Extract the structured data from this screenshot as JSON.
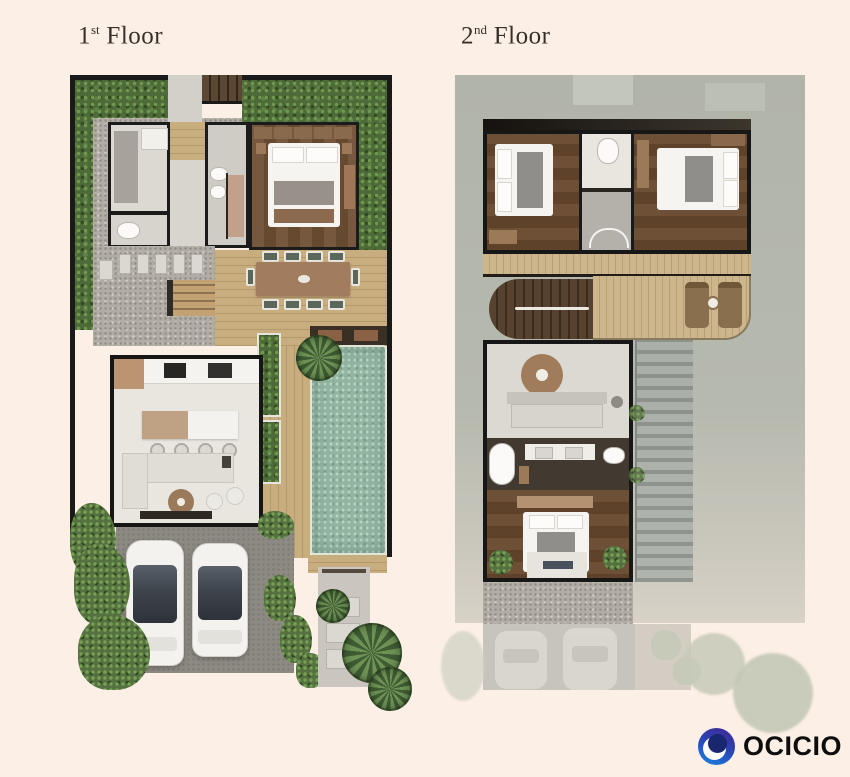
{
  "page": {
    "background_color": "#fcefe6"
  },
  "header": {
    "floor1": {
      "number": "1",
      "ordinal": "st",
      "word": "Floor"
    },
    "floor2": {
      "number": "2",
      "ordinal": "nd",
      "word": "Floor"
    }
  },
  "brand": {
    "name": "OCICIO",
    "text_color": "#0d0d0d",
    "mark_colors": {
      "indigo": "#3a2f9d",
      "blue": "#1b74d8",
      "core_navy": "#18276f",
      "swoosh": "#ffffff"
    }
  },
  "palette": {
    "title_text": "#37302a",
    "hedge_green": "#4d6a39",
    "gravel": "#b1ada5",
    "deck_wood": "#c8ad7f",
    "dark_wood_floor": "#6d5036",
    "wall_black": "#1a1a1a",
    "room_light_floor": "#e9e6e0",
    "pool_water": "#92b4a1",
    "furniture_brown": "#a27c5f",
    "sofa_gray": "#e0ddd6",
    "driveway_asphalt": "#8d8a83",
    "second_floor_surround": "#b4b7ac"
  }
}
